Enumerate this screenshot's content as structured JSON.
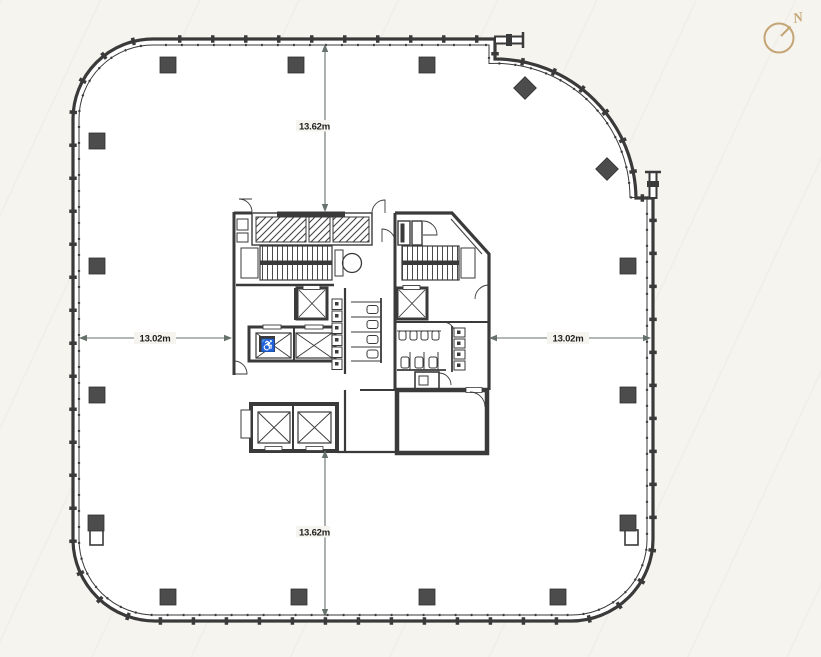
{
  "drawing": {
    "type": "office-tower-typical-floor-plan"
  },
  "dimensions": {
    "top": "13.62m",
    "bottom": "13.62m",
    "left": "13.02m",
    "right": "13.02m"
  },
  "compass": {
    "label": "N"
  },
  "colors": {
    "wall": "#3a3a3a",
    "col": "#4c4c4c",
    "dim": "#66716b",
    "ink": "#1f1f1d",
    "compass": "#c4a575",
    "bg": "#f6f4ef",
    "floor": "#ffffff"
  }
}
